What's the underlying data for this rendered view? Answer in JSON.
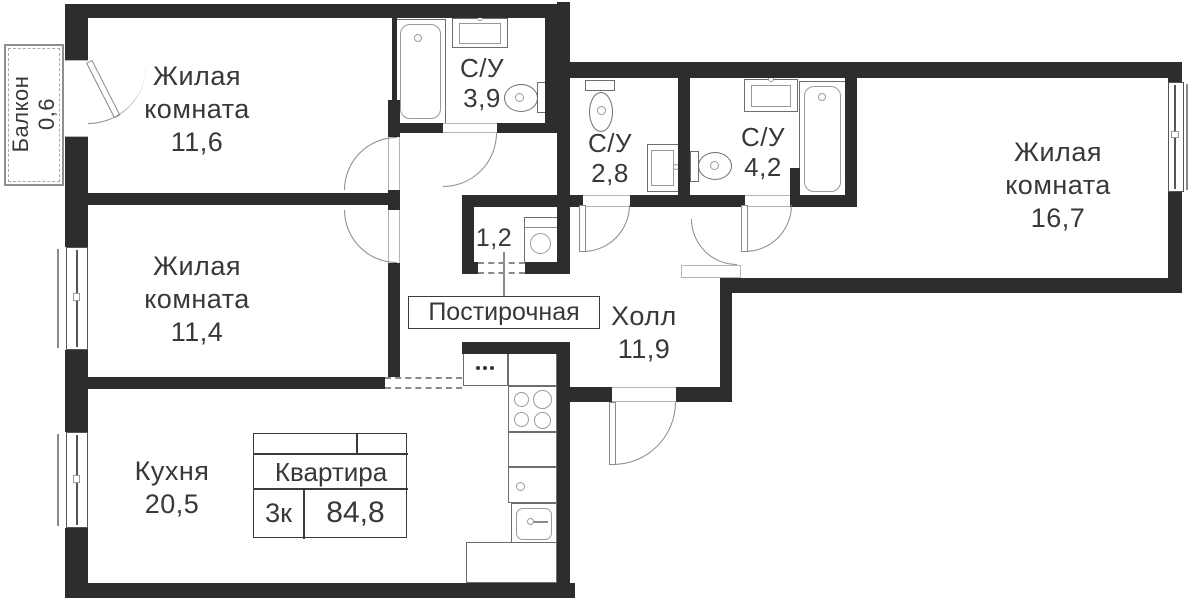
{
  "stamp": {
    "title": "Квартира",
    "rooms_count": "3к",
    "total_area": "84,8"
  },
  "callout": {
    "laundry": "Постирочная"
  },
  "rooms": {
    "living_room_1": {
      "line1": "Жилая",
      "line2": "комната",
      "area": "11,6"
    },
    "living_room_2": {
      "line1": "Жилая",
      "line2": "комната",
      "area": "11,4"
    },
    "living_room_3": {
      "line1": "Жилая",
      "line2": "комната",
      "area": "16,7"
    },
    "bathroom_1": {
      "label": "С/У",
      "area": "3,9"
    },
    "bathroom_2": {
      "label": "С/У",
      "area": "2,8"
    },
    "bathroom_3": {
      "label": "С/У",
      "area": "4,2"
    },
    "hall": {
      "label": "Холл",
      "area": "11,9"
    },
    "kitchen": {
      "label": "Кухня",
      "area": "20,5"
    },
    "laundry": {
      "area": "1,2"
    },
    "balcony": {
      "label": "Балкон",
      "area": "0,6"
    }
  },
  "colors": {
    "wall": "#2d2d2d",
    "fixture_line": "#6e6e6e",
    "text": "#383838"
  }
}
